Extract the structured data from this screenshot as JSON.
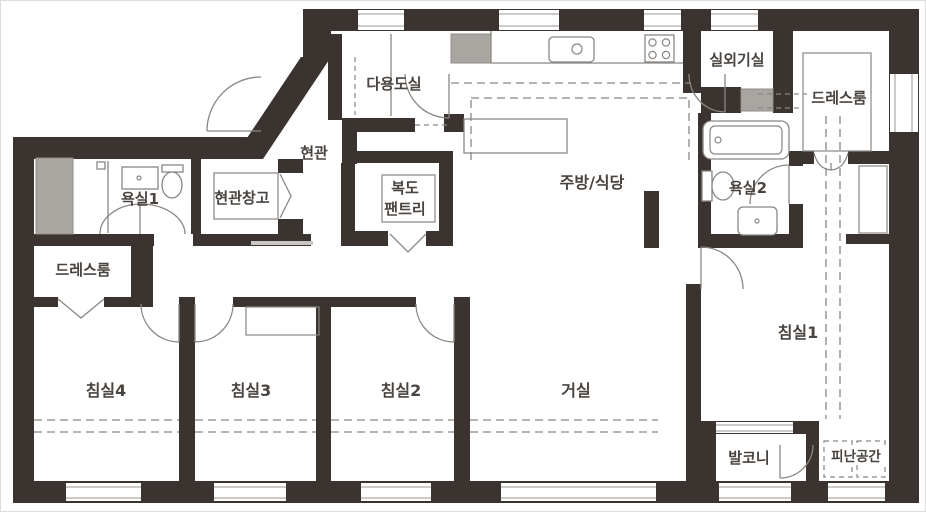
{
  "title": "apartment-floor-plan",
  "colors": {
    "wall": "#3a332f",
    "line": "#8a8683",
    "gray_fill": "#a9a6a2",
    "text": "#4a4440",
    "bg": "#ffffff"
  },
  "rooms": {
    "utility": {
      "label": "다용도실"
    },
    "outdoor_unit": {
      "label": "실외기실"
    },
    "dressroom_right": {
      "label": "드레스룸"
    },
    "entrance": {
      "label": "현관"
    },
    "bathroom1": {
      "label": "욕실1"
    },
    "entrance_storage": {
      "label": "현관창고"
    },
    "pantry": {
      "line1": "복도",
      "line2": "팬트리"
    },
    "kitchen_dining": {
      "label": "주방/식당"
    },
    "bathroom2": {
      "label": "욕실2"
    },
    "dressroom_left": {
      "label": "드레스룸"
    },
    "bedroom1": {
      "label": "침실1"
    },
    "bedroom2": {
      "label": "침실2"
    },
    "bedroom3": {
      "label": "침실3"
    },
    "bedroom4": {
      "label": "침실4"
    },
    "living": {
      "label": "거실"
    },
    "balcony": {
      "label": "발코니"
    },
    "refuge": {
      "label": "피난공간"
    }
  },
  "fixtures": [
    "kitchen-sink",
    "gas-stove",
    "dining-table",
    "bathtub",
    "toilet",
    "washbasin",
    "duct-shaft",
    "appliance",
    "outdoor-unit-pad",
    "wardrobe",
    "closet",
    "door-swing",
    "bifold-door",
    "window",
    "evacuation-area-marking",
    "entrance-step"
  ]
}
